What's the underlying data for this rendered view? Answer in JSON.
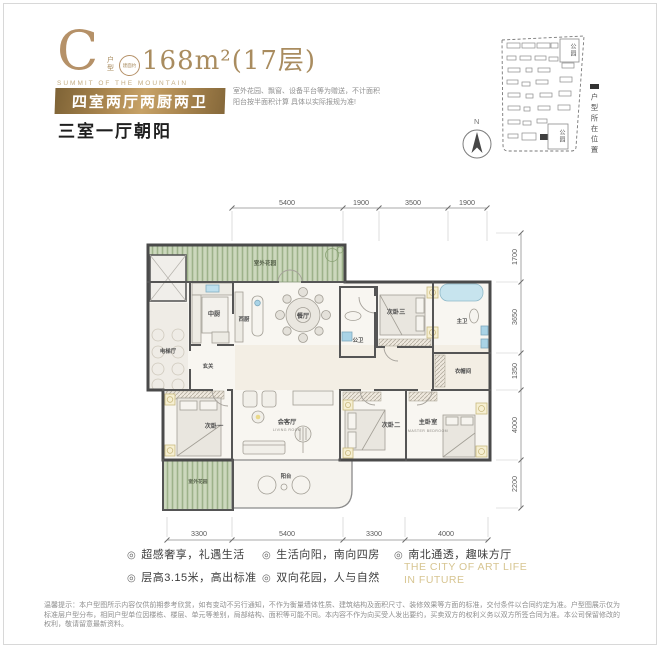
{
  "header": {
    "unit_letter": "C",
    "unit_mini_label": "户型",
    "seal_text": "建面约",
    "area_text": "168m²(17层)",
    "subtitle_en": "SUMMIT OF THE MOUNTAIN",
    "banner": "四室两厅两厨两卫",
    "orientation": "三室一厅朝阳",
    "note_line1": "室外花园、飘窗、设备平台等为赠送，不计面积",
    "note_line2": "阳台按半面积计算  具体以实际报规为准!"
  },
  "site_map": {
    "park_top": "公园",
    "park_bottom": "公园",
    "marker_label": "户型所在位置",
    "compass": "N"
  },
  "floorplan": {
    "dims_top": [
      "5400",
      "1900",
      "3500",
      "1900"
    ],
    "dims_right": [
      "1700",
      "3650",
      "1350",
      "4000",
      "2200"
    ],
    "dims_bottom": [
      "3300",
      "5400",
      "3300",
      "4000"
    ],
    "rooms": {
      "garden_top": "室外花园",
      "garden_bottom": "室外花园",
      "kitchen_chinese": "中厨",
      "kitchen_western": "西厨",
      "dining": "餐厅",
      "elevator_hall": "电梯厅",
      "foyer": "玄关",
      "bath_public": "公卫",
      "bedroom3": "次卧三",
      "bath_master": "主卫",
      "cloakroom": "衣帽间",
      "bedroom1": "次卧一",
      "living": "会客厅",
      "living_en": "LIVING ROOM",
      "balcony": "阳台",
      "bedroom2": "次卧二",
      "master_bedroom": "主卧室",
      "master_en": "MASTER BEDROOM"
    }
  },
  "features": [
    {
      "icon": "◎",
      "text": "超感奢享，礼遇生活"
    },
    {
      "icon": "◎",
      "text": "层高3.15米，高出标准"
    },
    {
      "icon": "◎",
      "text": "生活向阳，南向四房"
    },
    {
      "icon": "◎",
      "text": "双向花园，人与自然"
    },
    {
      "icon": "◎",
      "text": "南北通透，趣味方厅"
    }
  ],
  "slogan_line1": "THE CITY OF ART LIFE",
  "slogan_line2": "IN FUTURE",
  "disclaimer": "温馨提示：本户型图所示内容仅供前期参考欣赏，如有变动不另行通知，不作为衡量墙体性质、建筑结构及面积尺寸、装修效果等方面的标准，交付条件以合同约定为准。户型图展示仅为标准层户型分布，相同户型单位因楼栋、楼层、单元等差别，局部结构、面积等可能不同。本内容不作为向买受人发出要约，买卖双方的权利义务以双方所签合同为准。本公司保留修改的权利，敬请留意最新资料。"
}
